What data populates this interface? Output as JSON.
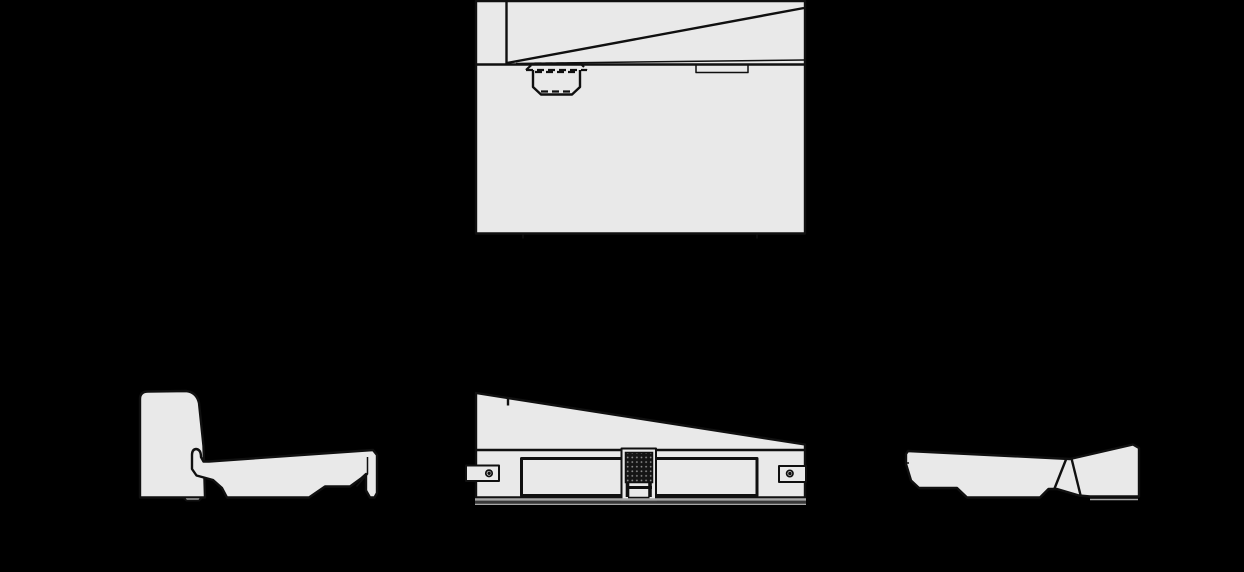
{
  "canvas": {
    "width": 1244,
    "height": 572,
    "background": "#000000"
  },
  "style": {
    "part_fill": "#e9e9e9",
    "line_color": "#101010",
    "ghost_line_color": "#a8a8a8",
    "ghost_dark_line_color": "#4a4a4a",
    "hatch_fill": "#151515",
    "hatch_dot": "#8a8a8a"
  },
  "views": {
    "plan": {
      "body_d": "M476,1 L805,1 L805,233.5 L476,233.5 Z",
      "divider_v_d": "M506.5,1 L506.5,64",
      "edge_h_d": "M476,64.5 L805,64.5",
      "taper_d": "M507,63 L804,8",
      "taper2_d": "M516,63.5 L804,60",
      "latch_flange_d": "M526,70 L533,63.5 L580.5,63.5 L587,70",
      "latch_flange_bottom_d": "M526,70 L587,70",
      "latch_body_d": "M533,70 L533,87 L541,94.5 L572,94.5 L580,87 L580,70",
      "latch_hidden_top_d": "M535,72 L578,72",
      "latch_hidden_bottom_d": "M541,91.5 L572,91.5",
      "tab_d": "M696,65.5 L696,72.5 L748,72.5 L748,65.5",
      "tick_left_d": "M523,233.5 L523,238.5",
      "tick_right_d": "M757,233.5 L757,238.5"
    },
    "front": {
      "body_d": "M476,393 L805,444.5 L805,497.5 L476,497.5 Z",
      "seam_tick_d": "M508,397.5 L508,405.5",
      "base_line_d": "M476,450 L805,450",
      "left_tab_d": "M499,465.5 L466,465.5 L466,481 L499,481 Z",
      "left_hole_d": "M485.8,473.3 a3.2,3.2 0 1,0 6.4,0 a3.2,3.2 0 1,0 -6.4,0 M488.2,473.3 a0.9,0.9 0 1,0 1.8,0 a0.9,0.9 0 1,0 -1.8,0",
      "right_tab_d": "M779,466 L806,466 L806,482 L779,482 Z",
      "right_hole_d": "M786.6,473.5 a3.2,3.2 0 1,0 6.4,0 a3.2,3.2 0 1,0 -6.4,0 M789,473.5 a0.9,0.9 0 1,0 1.8,0 a0.9,0.9 0 1,0 -1.8,0",
      "left_panel_d": "M521.5,458.5 L624.5,458.5 L624.5,495.5 L521.5,495.5 Z",
      "right_panel_d": "M655.5,458.5 L757,458.5 L757,495.5 L655.5,495.5 Z",
      "connector_outer_d": "M621.5,448.5 L656,448.5 L656,501 L621.5,501 Z",
      "connector_block_d": "M625.5,452.5 L652.5,452.5 L652.5,482.5 L625.5,482.5 Z",
      "connector_leg_left_d": "M627.5,482.5 L627.5,497",
      "connector_leg_right_d": "M650,482.5 L650,497",
      "connector_bar_d": "M626,487.5 L652,487.5",
      "connector_foot_d": "M628,498.5 L649.5,498.5",
      "ground1_d": "M475,499.5 L806,499.5",
      "ground2_d": "M475,502 L806,502",
      "ground3_d": "M475,504.2 L806,504.2"
    },
    "side_left": {
      "backrest_d": "M140,497.5 L140,399 Q140,391.5 148,391.5 L186,391 Q196.5,392 199,403 L203.5,446 L205,497.5 Z",
      "backrest_foot_d": "M183,497.5 L186.5,500.5 L199,500.5 L202,497.5 Z",
      "seat_d": "M196,449 Q192,449.5 192,455 L192,469 L196.5,475.5 L213,480 L222,488 L227,497.5 L309,497.5 L325,486.5 L350,486.5 L361,478.5 L366,474 L366,490.5 L370,497.5 L374.5,497.5 L377,493 L377,455 L373,450 L209,461.5 L203.5,461.5 L201,457 Q201,449.5 196,449 Z",
      "seat_echo_d": "M367.5,457 L367.5,474 L356.5,486.5"
    },
    "side_right": {
      "body_d": "M908,451 L1070,459 L1133,444.5 L1139,448 L1139,496.5 L1090,496.5 L1079,495.5 L1057,489 L1048.5,489 L1040,497.5 L967,497.5 L957,488 L919,488 L911,480.5 L906,464 L906,454 Z",
      "seam1_d": "M1066,459.5 L1054.5,488.5",
      "seam2_d": "M1071.5,458.5 L1080.5,495",
      "edge_step_d": "M909,463 L905.5,463",
      "ground_echo_d": "M1090,499.5 L1138,499.5"
    }
  }
}
